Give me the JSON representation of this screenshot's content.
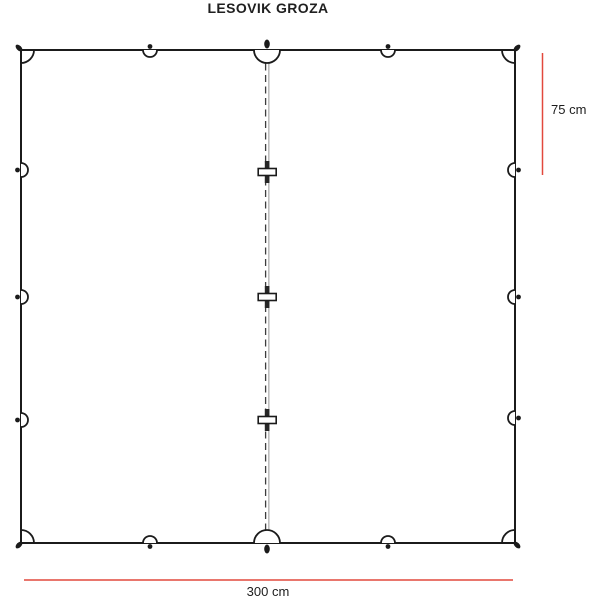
{
  "title": "LESOVIK GROZA",
  "dimensions": {
    "width_label": "300 cm",
    "spacing_label": "75 cm"
  },
  "colors": {
    "dimension_red": "#e2483d",
    "line_dark": "#1b1b1b"
  },
  "diagram": {
    "type": "tarp-top-view-schematic",
    "perimeter_attachment_loops": 16,
    "ridge_toggles": 3
  }
}
